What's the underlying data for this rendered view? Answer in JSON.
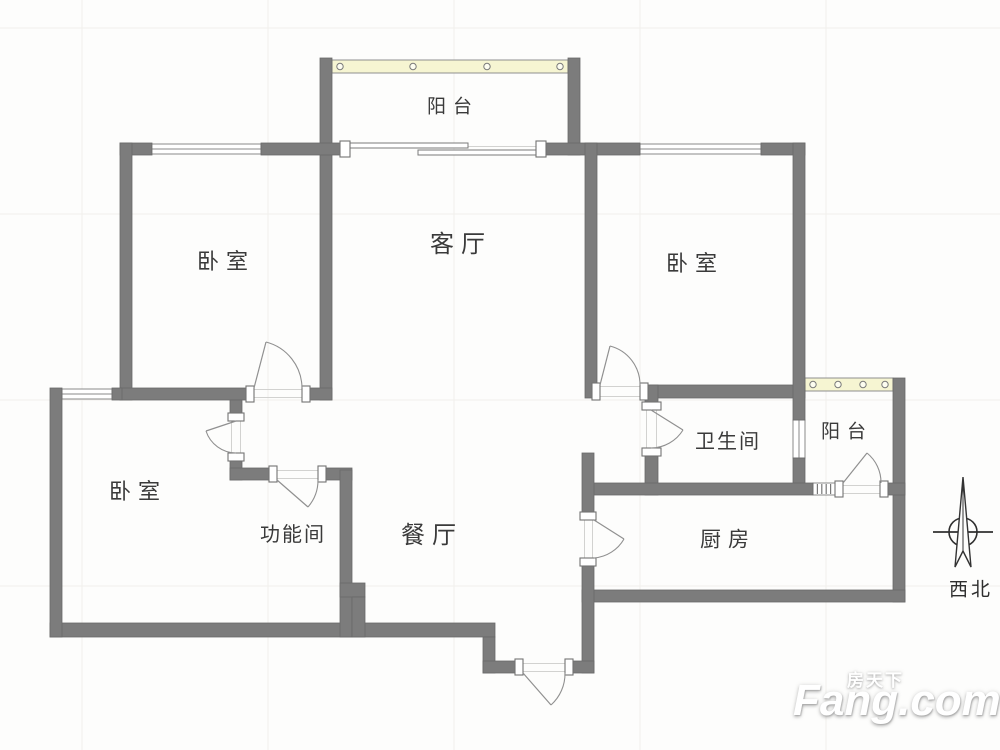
{
  "plan_title": "floor-plan",
  "colors": {
    "wall": "#7c7c7c",
    "wall_edge": "#696969",
    "window_fill": "#ffffff",
    "window_line": "#8a8a8a",
    "band_fill": "#f6f5d2",
    "band_edge": "#8f8f8f",
    "door_arc": "#909090",
    "jamb_fill": "#ffffff",
    "jamb_edge": "#737373",
    "threshold": "#d2d2d0",
    "grid": "#f1f0ec",
    "label": "#3a3a3a"
  },
  "rooms": [
    {
      "id": "balcony-top",
      "label": "阳台",
      "x": 453,
      "y": 107,
      "size": 19
    },
    {
      "id": "bedroom-upper-left",
      "label": "卧室",
      "x": 226,
      "y": 262,
      "size": 22
    },
    {
      "id": "living-room",
      "label": "客厅",
      "x": 461,
      "y": 245,
      "size": 24
    },
    {
      "id": "bedroom-upper-right",
      "label": "卧室",
      "x": 695,
      "y": 264,
      "size": 22
    },
    {
      "id": "bedroom-lower-left",
      "label": "卧室",
      "x": 138,
      "y": 492,
      "size": 22
    },
    {
      "id": "function-room",
      "label": "功能间",
      "x": 293,
      "y": 535,
      "size": 20
    },
    {
      "id": "dining-room",
      "label": "餐厅",
      "x": 432,
      "y": 536,
      "size": 24
    },
    {
      "id": "bathroom",
      "label": "卫生间",
      "x": 728,
      "y": 442,
      "size": 20
    },
    {
      "id": "balcony-right",
      "label": "阳台",
      "x": 847,
      "y": 432,
      "size": 19
    },
    {
      "id": "kitchen",
      "label": "厨房",
      "x": 728,
      "y": 540,
      "size": 21
    }
  ],
  "compass": {
    "label": "西北"
  },
  "watermark": {
    "cn": "房天下",
    "en": "Fang.com"
  },
  "geometry": {
    "grid": {
      "xs": [
        82,
        268,
        454,
        640,
        826
      ],
      "ys": [
        28,
        214,
        400,
        586
      ]
    },
    "walls": [
      [
        320,
        58,
        12,
        342
      ],
      [
        568,
        58,
        12,
        97
      ],
      [
        120,
        143,
        32,
        12
      ],
      [
        261,
        143,
        79,
        12
      ],
      [
        546,
        143,
        94,
        12
      ],
      [
        761,
        143,
        44,
        12
      ],
      [
        120,
        143,
        12,
        257
      ],
      [
        120,
        388,
        126,
        12
      ],
      [
        302,
        388,
        30,
        12
      ],
      [
        585,
        143,
        12,
        255
      ],
      [
        648,
        385,
        157,
        13
      ],
      [
        793,
        143,
        12,
        277
      ],
      [
        793,
        458,
        12,
        32
      ],
      [
        893,
        378,
        12,
        224
      ],
      [
        645,
        385,
        13,
        17
      ],
      [
        645,
        456,
        13,
        39
      ],
      [
        592,
        483,
        221,
        12
      ],
      [
        888,
        483,
        17,
        12
      ],
      [
        582,
        590,
        323,
        12
      ],
      [
        582,
        453,
        12,
        59
      ],
      [
        582,
        566,
        12,
        107
      ],
      [
        50,
        623,
        445,
        14
      ],
      [
        50,
        388,
        12,
        249
      ],
      [
        112,
        388,
        10,
        12
      ],
      [
        230,
        400,
        12,
        13
      ],
      [
        230,
        461,
        12,
        19
      ],
      [
        230,
        468,
        39,
        12
      ],
      [
        326,
        468,
        26,
        12
      ],
      [
        340,
        470,
        12,
        167
      ],
      [
        340,
        583,
        25,
        14
      ],
      [
        352,
        597,
        13,
        40
      ],
      [
        483,
        637,
        12,
        36
      ],
      [
        483,
        661,
        40,
        12
      ],
      [
        573,
        661,
        21,
        12
      ]
    ],
    "windows": [
      {
        "x": 150,
        "y": 144,
        "w": 111,
        "h": 10,
        "type": "h",
        "name": "bedroom-upper-left-window"
      },
      {
        "x": 640,
        "y": 144,
        "w": 121,
        "h": 10,
        "type": "h",
        "name": "bedroom-upper-right-window"
      },
      {
        "x": 62,
        "y": 389,
        "w": 50,
        "h": 10,
        "type": "h",
        "name": "bedroom-lower-left-window"
      },
      {
        "x": 793,
        "y": 420,
        "w": 12,
        "h": 38,
        "type": "v",
        "name": "bathroom-balcony-window"
      },
      {
        "x": 321,
        "y": 88,
        "w": 10,
        "h": 32,
        "type": "v",
        "name": "balcony-top-side-window"
      },
      {
        "x": 813,
        "y": 483,
        "w": 22,
        "h": 12,
        "type": "hatch",
        "name": "kitchen-balcony-small-window"
      }
    ],
    "bands": [
      {
        "x": 332,
        "y": 60,
        "w": 236,
        "h": 13,
        "circles": [
          340,
          413,
          487,
          560
        ],
        "name": "balcony-top-window-band"
      },
      {
        "x": 805,
        "y": 378,
        "w": 88,
        "h": 13,
        "circles": [
          813,
          838,
          863,
          885
        ],
        "name": "balcony-right-window-band"
      }
    ],
    "slides": [
      {
        "x": 350,
        "y": 143,
        "w": 118,
        "h": 5,
        "name": "living-balcony-sliding-panel-1"
      },
      {
        "x": 418,
        "y": 150,
        "w": 119,
        "h": 5,
        "name": "living-balcony-sliding-panel-2"
      }
    ],
    "jambs": [
      [
        246,
        386,
        8,
        16
      ],
      [
        302,
        386,
        8,
        16
      ],
      [
        340,
        141,
        10,
        16
      ],
      [
        536,
        141,
        10,
        16
      ],
      [
        592,
        383,
        8,
        17
      ],
      [
        640,
        383,
        8,
        17
      ],
      [
        642,
        402,
        19,
        8
      ],
      [
        642,
        448,
        19,
        8
      ],
      [
        835,
        481,
        8,
        16
      ],
      [
        880,
        481,
        8,
        16
      ],
      [
        580,
        512,
        16,
        8
      ],
      [
        580,
        558,
        16,
        8
      ],
      [
        515,
        659,
        8,
        16
      ],
      [
        565,
        659,
        8,
        16
      ],
      [
        228,
        413,
        16,
        8
      ],
      [
        228,
        453,
        16,
        8
      ],
      [
        269,
        466,
        8,
        16
      ],
      [
        318,
        466,
        8,
        16
      ]
    ],
    "thresholds": [
      [
        254,
        389,
        48,
        1
      ],
      [
        254,
        397,
        48,
        1
      ],
      [
        600,
        386,
        40,
        1
      ],
      [
        600,
        396,
        40,
        1
      ],
      [
        646,
        410,
        1,
        38
      ],
      [
        656,
        410,
        1,
        38
      ],
      [
        843,
        485,
        37,
        1
      ],
      [
        843,
        493,
        37,
        1
      ],
      [
        584,
        520,
        1,
        38
      ],
      [
        592,
        520,
        1,
        38
      ],
      [
        523,
        663,
        42,
        1
      ],
      [
        523,
        671,
        42,
        1
      ],
      [
        231,
        421,
        1,
        32
      ],
      [
        240,
        421,
        1,
        32
      ],
      [
        277,
        470,
        41,
        1
      ],
      [
        277,
        478,
        41,
        1
      ],
      [
        350,
        146,
        187,
        1
      ]
    ],
    "doors": [
      {
        "name": "bedroom-upper-left-door",
        "leaf": "M254,388 L266,342",
        "arc": "M266,342 A48,48 0 0 1 302,388"
      },
      {
        "name": "bedroom-upper-right-door",
        "leaf": "M600,385 L610,346",
        "arc": "M610,346 A40,40 0 0 1 640,385"
      },
      {
        "name": "bathroom-door",
        "leaf": "M651,410 L683,430",
        "arc": "M683,430 A38,38 0 0 1 651,448"
      },
      {
        "name": "balcony-right-door",
        "leaf": "M843,483 L867,453",
        "arc": "M867,453 A38,38 0 0 1 881,483"
      },
      {
        "name": "kitchen-door",
        "leaf": "M594,520 L624,539",
        "arc": "M624,539 A38,38 0 0 1 594,558"
      },
      {
        "name": "entrance-door",
        "leaf": "M523,673 L551,705",
        "arc": "M551,705 A42,42 0 0 0 565,673"
      },
      {
        "name": "bedroom-lower-left-door",
        "leaf": "M236,421 L206,431",
        "arc": "M206,431 A32,32 0 0 0 236,453"
      },
      {
        "name": "function-room-door",
        "leaf": "M277,480 L308,507",
        "arc": "M308,507 A41,41 0 0 0 318,480"
      }
    ]
  }
}
